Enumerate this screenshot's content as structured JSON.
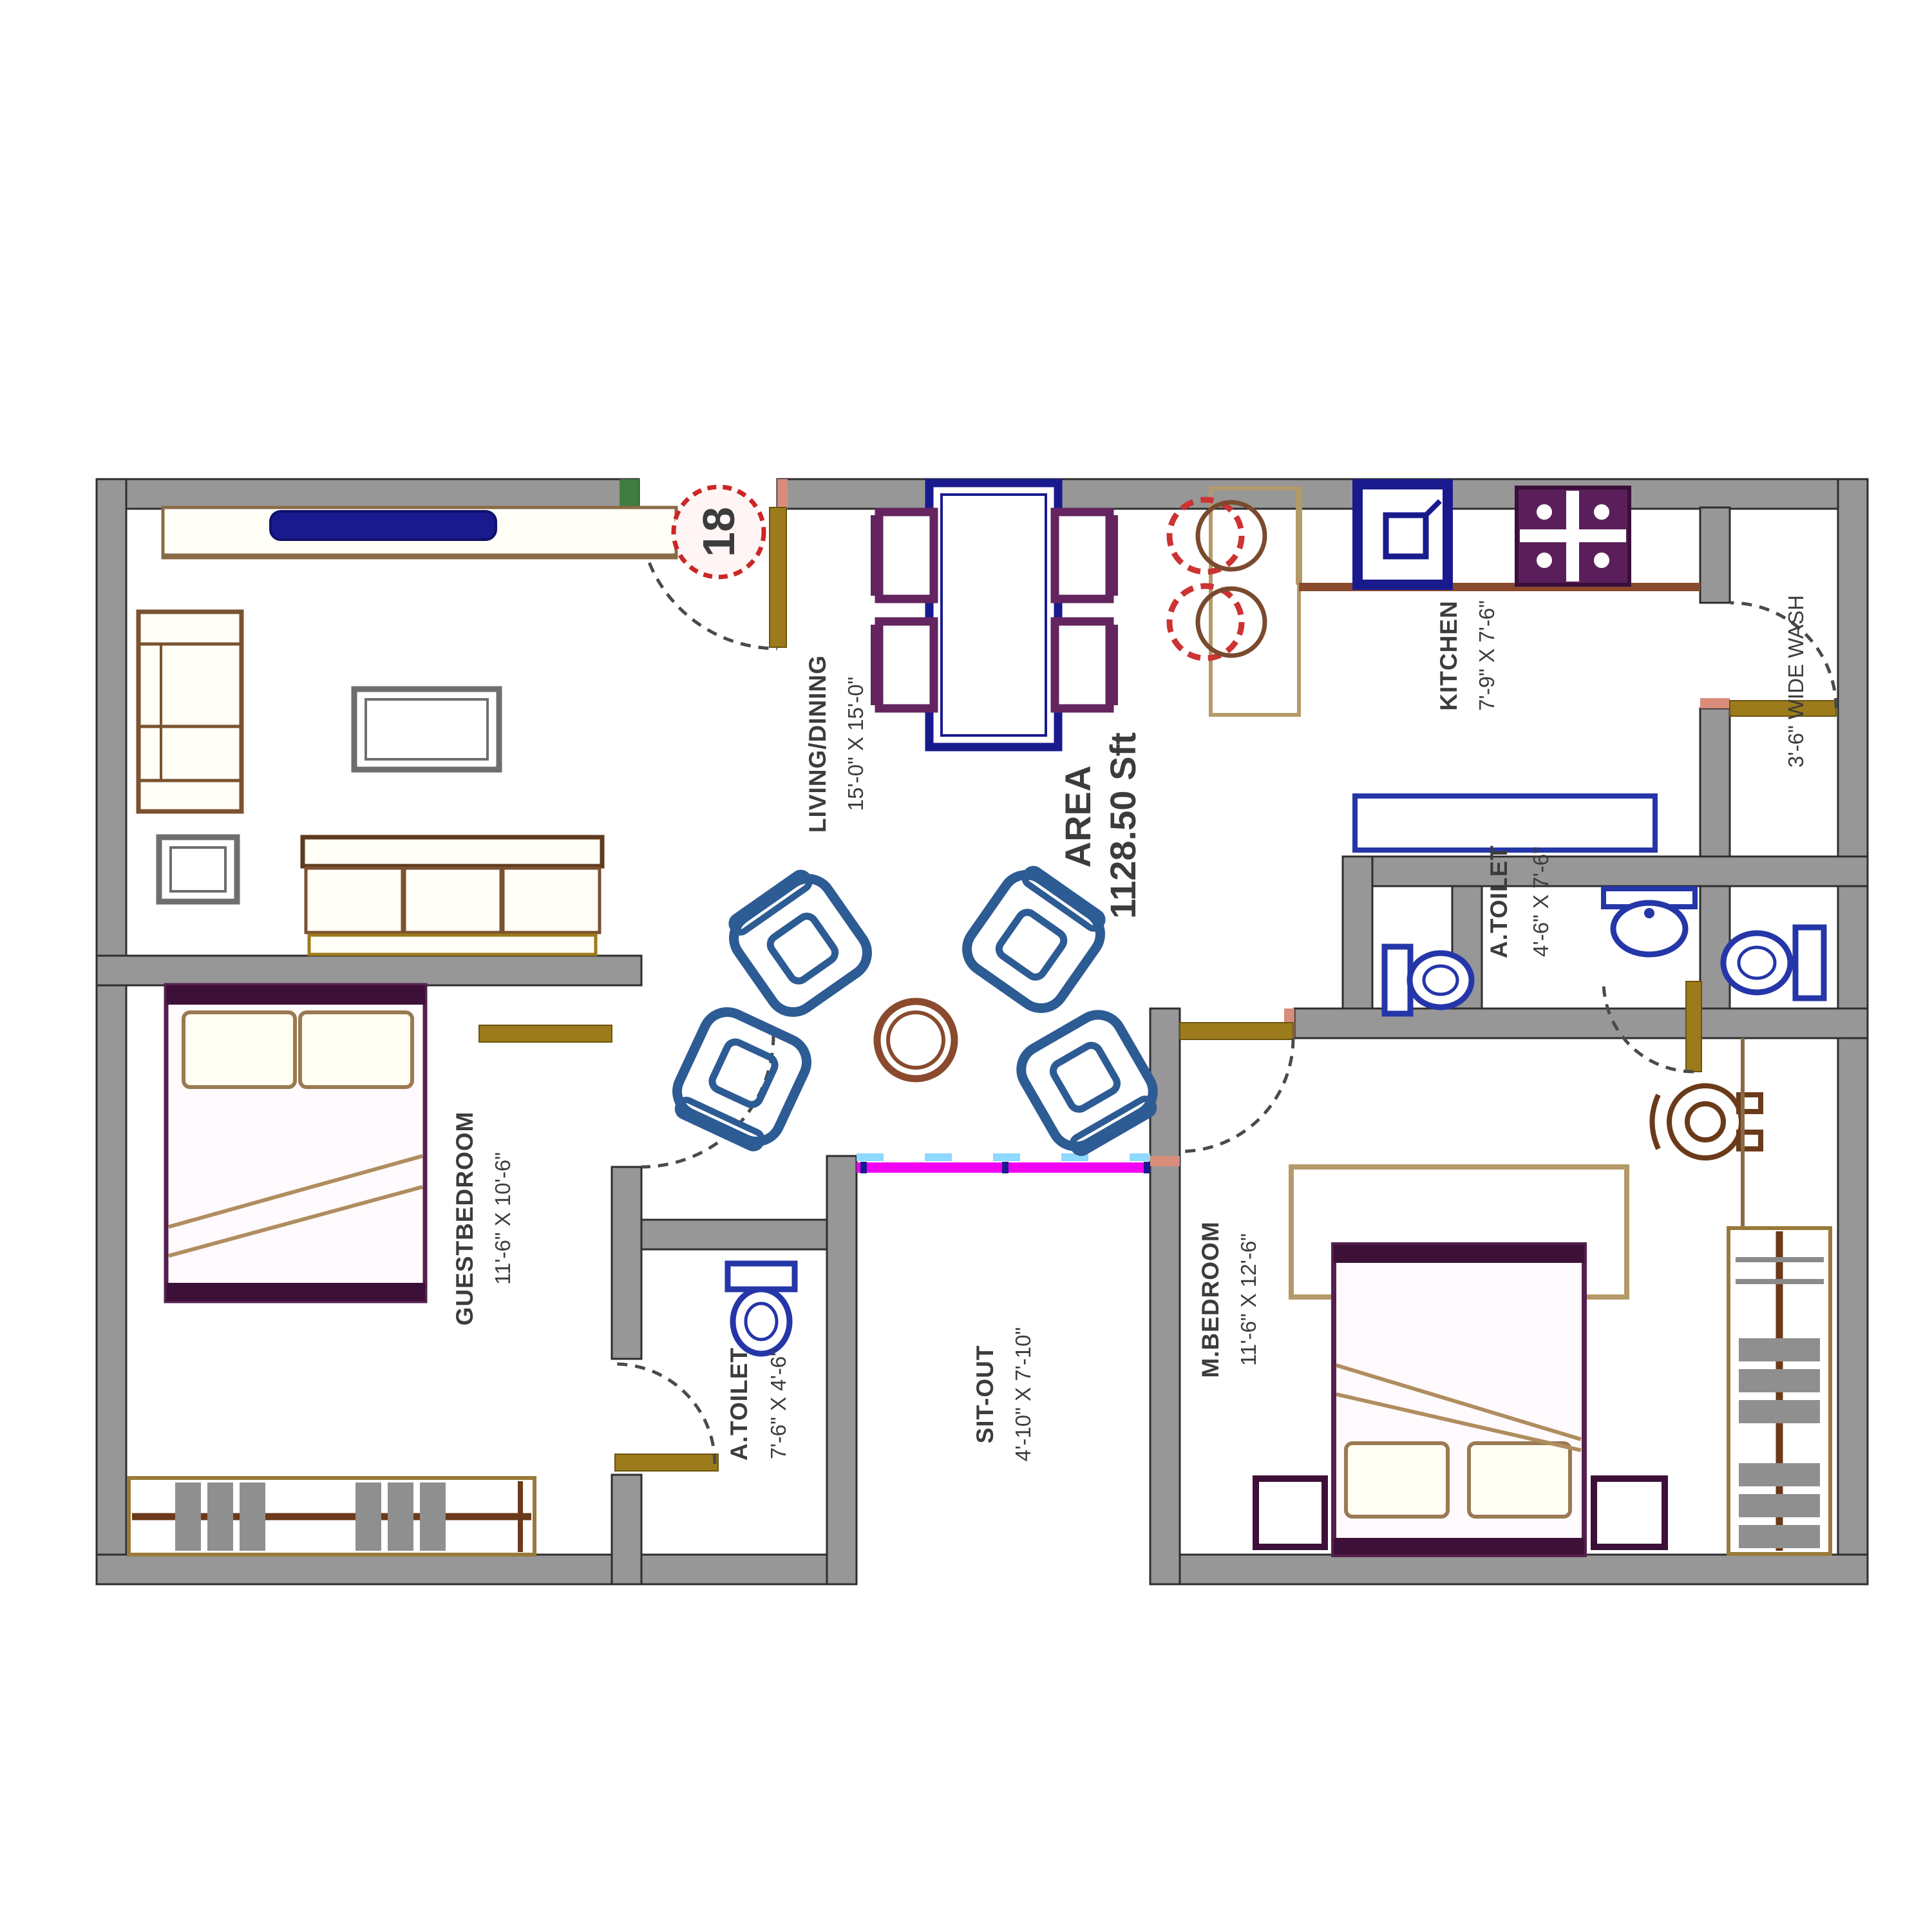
{
  "plan": {
    "stamp": {
      "number": "18"
    },
    "area": {
      "line1": "AREA",
      "line2": "1128.50 Sft"
    },
    "rooms": {
      "living": {
        "name": "LIVING/DINING",
        "dims": "15'-0\" X 15'-0\""
      },
      "kitchen": {
        "name": "KITCHEN",
        "dims": "7'-9\" X 7'-6\""
      },
      "wash": {
        "name": "3'-6\" WIDE WASH"
      },
      "toilet_right": {
        "name": "A.TOILET",
        "dims": "4'-6\" X 7'-6\""
      },
      "toilet_left": {
        "name": "A.TOILET",
        "dims": "7'-6\" X 4'-6\""
      },
      "master_bedroom": {
        "name": "M.BEDROOM",
        "dims": "11'-6\" X 12'-6\""
      },
      "guest_bedroom": {
        "name": "GUESTBEDROOM",
        "dims": "11'-6\" X 10'-6\""
      },
      "sitout": {
        "name": "SIT-OUT",
        "dims": "4'-10\" X 7'-10\""
      }
    },
    "colors": {
      "wall": "#979797",
      "accent_red": "#cc2626",
      "sliding_door_magenta": "#f200f2",
      "sliding_door_cyan": "#8fd8ff",
      "fixture_blue": "#2436a8",
      "furniture_navy": "#1a1a8f",
      "furniture_purple": "#632460",
      "door_tan": "#9c7b1c",
      "sofa_steel_blue": "#2d5b94"
    }
  }
}
